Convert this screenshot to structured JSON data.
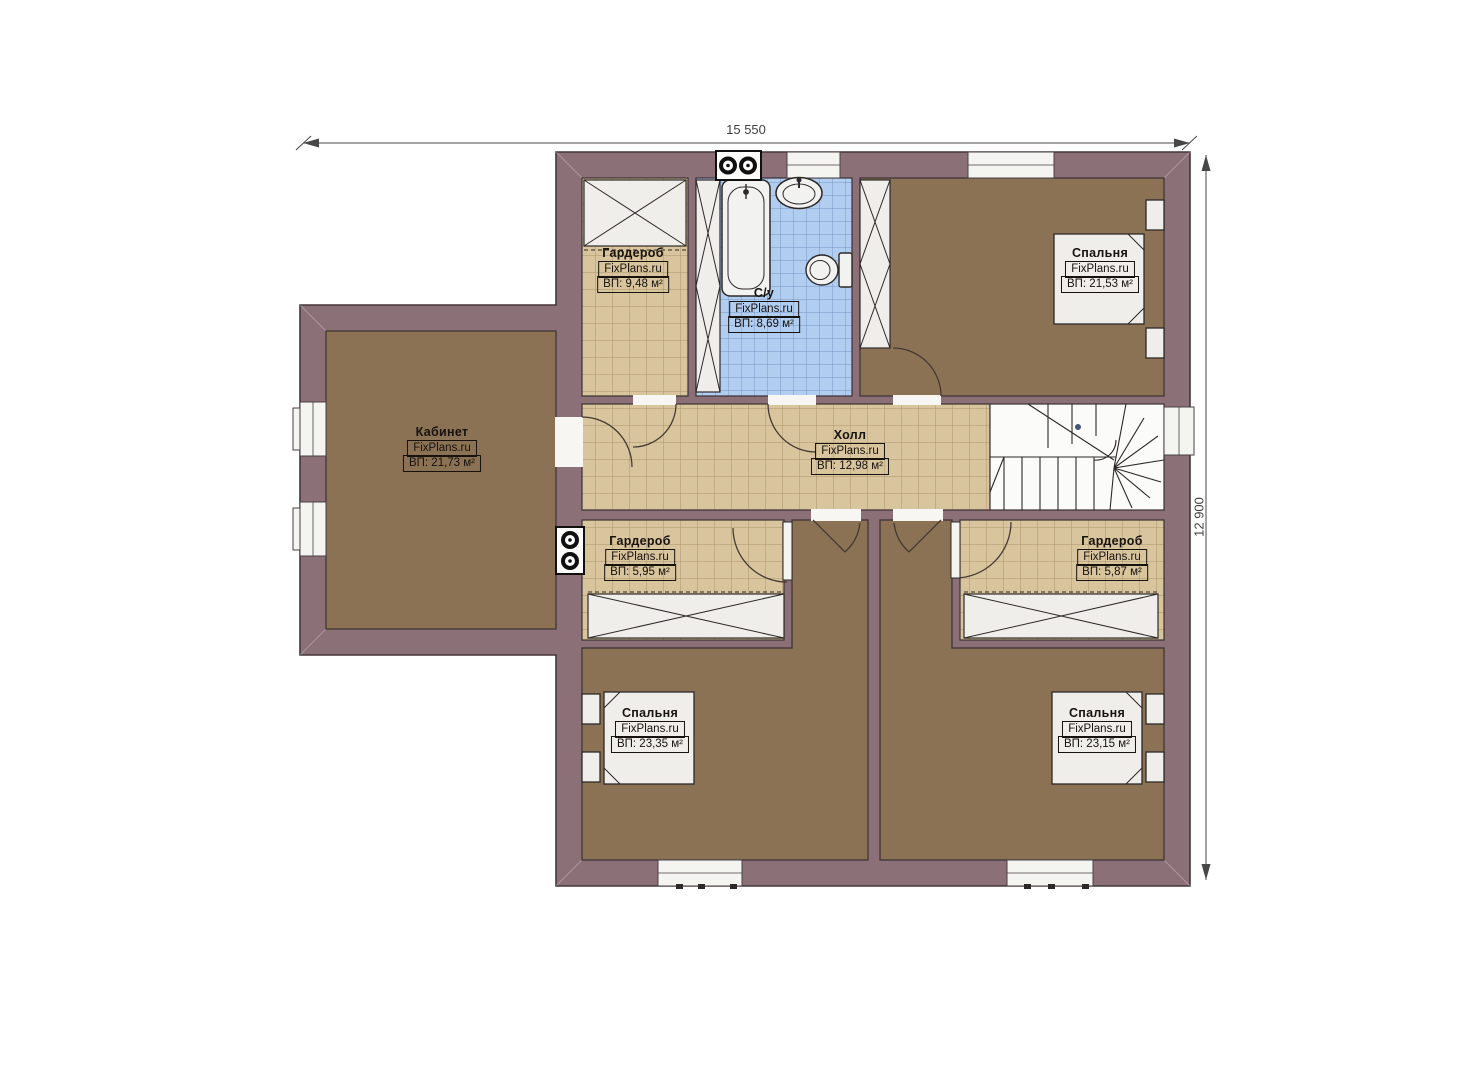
{
  "plan": {
    "type": "second-floor apartment plan",
    "dimensions": {
      "width_label": "15 550",
      "height_label": "12 900"
    },
    "watermark": "FixPlans.ru",
    "palette": {
      "wall": "#8c7077",
      "wall_outline": "#43363a",
      "wood_floor": "#8b7254",
      "tile_beige": "#d9c59d",
      "tile_beige_line": "#7a5f37",
      "tile_blue": "#b1cef1",
      "tile_blue_line": "#46699f",
      "fixture_fill": "#efeeeb",
      "fixture_stroke": "#2e2928",
      "dimension_color": "#474747"
    },
    "rooms": [
      {
        "name": "Гардероб",
        "watermark": "FixPlans.ru",
        "area": "ВП: 9,48 м²"
      },
      {
        "name": "С/у",
        "watermark": "FixPlans.ru",
        "area": "ВП: 8,69 м²"
      },
      {
        "name": "Спальня",
        "watermark": "FixPlans.ru",
        "area": "ВП: 21,53 м²"
      },
      {
        "name": "Кабинет",
        "watermark": "FixPlans.ru",
        "area": "ВП: 21,73 м²"
      },
      {
        "name": "Холл",
        "watermark": "FixPlans.ru",
        "area": "ВП: 12,98 м²"
      },
      {
        "name": "Гардероб",
        "watermark": "FixPlans.ru",
        "area": "ВП: 5,95 м²"
      },
      {
        "name": "Гардероб",
        "watermark": "FixPlans.ru",
        "area": "ВП: 5,87 м²"
      },
      {
        "name": "Спальня",
        "watermark": "FixPlans.ru",
        "area": "ВП: 23,35 м²"
      },
      {
        "name": "Спальня",
        "watermark": "FixPlans.ru",
        "area": "ВП: 23,15 м²"
      }
    ]
  }
}
